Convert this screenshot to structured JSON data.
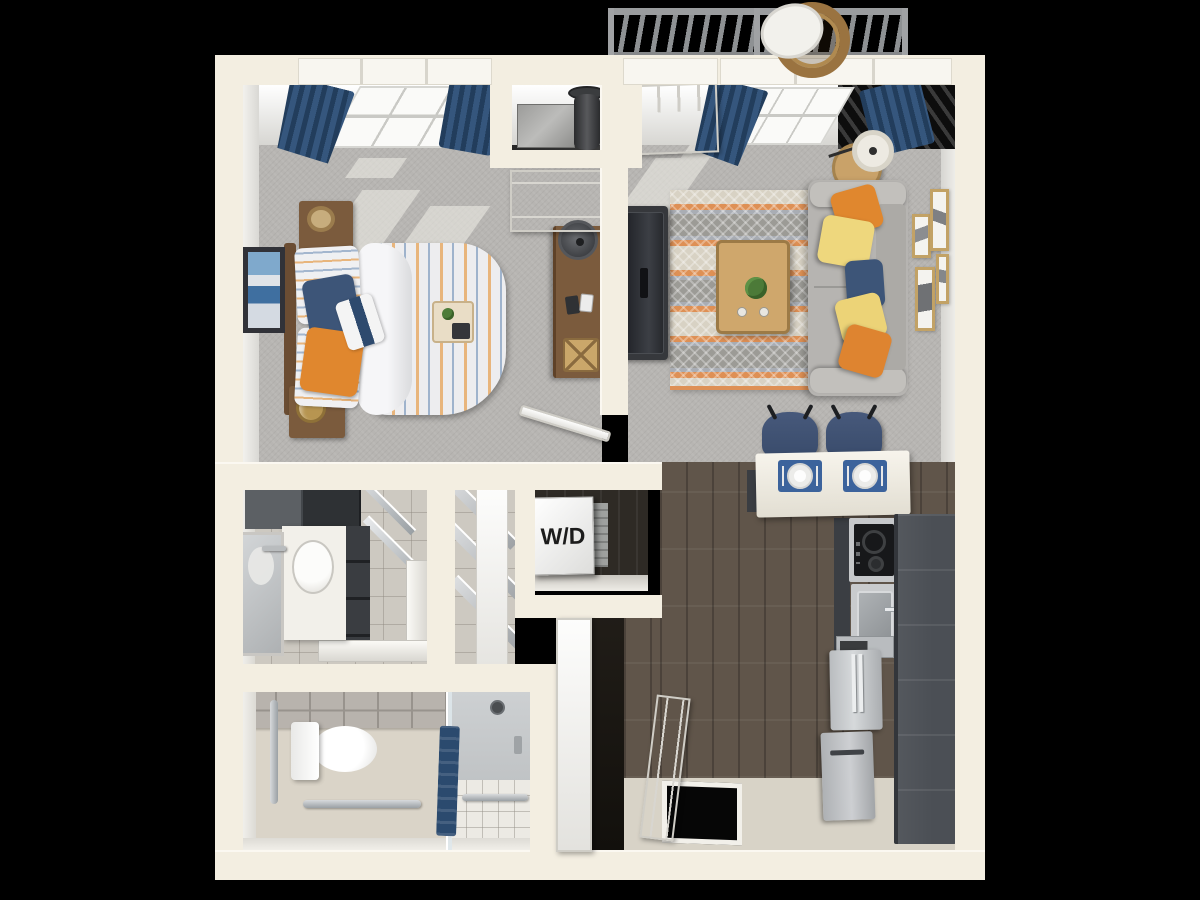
{
  "diagram": {
    "type": "3d-floor-plan",
    "unit": "one-bedroom apartment",
    "labels": {
      "washer_dryer": "W/D"
    },
    "rooms": [
      {
        "id": "bedroom",
        "name": "Bedroom",
        "floor": "carpet",
        "furniture": [
          "bed",
          "striped-duvet",
          "pillows",
          "nightstand-top",
          "nightstand-bottom",
          "table-lamp",
          "hat",
          "breakfast-tray",
          "desk",
          "desk-lamp",
          "basket",
          "wall-art",
          "window",
          "navy-curtains"
        ]
      },
      {
        "id": "living-room",
        "name": "Living Room",
        "floor": "carpet",
        "furniture": [
          "sofa",
          "throw-pillows",
          "area-rug",
          "coffee-table",
          "plant",
          "tv",
          "tv-stand",
          "floor-lamp",
          "side-table",
          "gallery-frames",
          "balcony-door",
          "window",
          "navy-curtains"
        ]
      },
      {
        "id": "balcony",
        "name": "Balcony",
        "floor": "deck",
        "furniture": [
          "railing",
          "hanging-wicker-chair"
        ]
      },
      {
        "id": "kitchen",
        "name": "Kitchen",
        "floor": "wood",
        "furniture": [
          "breakfast-bar",
          "bar-stools",
          "place-settings",
          "cooktop",
          "sink",
          "tall-cabinets",
          "microwave",
          "refrigerator",
          "dishwasher"
        ]
      },
      {
        "id": "entry",
        "name": "Entry",
        "floor": "wood",
        "furniture": [
          "front-door"
        ]
      },
      {
        "id": "laundry-closet",
        "name": "Laundry Closet",
        "floor": "wood",
        "furniture": [
          "stacked-washer-dryer"
        ]
      },
      {
        "id": "closet",
        "name": "Closet",
        "floor": "tile",
        "furniture": [
          "wire-shelving",
          "door"
        ]
      },
      {
        "id": "vanity-bathroom",
        "name": "Bathroom Vanity",
        "floor": "tile",
        "furniture": [
          "vanity-counter",
          "sink",
          "faucet",
          "mirror",
          "upper-cabinets",
          "drawer-stack",
          "shower-curb",
          "glass-door"
        ]
      },
      {
        "id": "bathroom",
        "name": "Accessible Bathroom",
        "floor": "tile",
        "furniture": [
          "toilet",
          "grab-bars",
          "roll-in-shower",
          "shower-head",
          "towel",
          "glass-partition"
        ]
      },
      {
        "id": "mechanical-closet",
        "name": "Mechanical Closet",
        "floor": "concrete",
        "furniture": [
          "water-heater",
          "hvac-box"
        ]
      }
    ],
    "palette": {
      "background": "#000000",
      "wall": "#f3eee1",
      "wall_face": "#ffffff",
      "carpet": "#b7b5b2",
      "wood_floor": "#60554a",
      "dark_wood": "#2c2824",
      "entry_floor": "#d8d3c7",
      "tile_floor": "#cdc9c1",
      "bath_floor": "#dad4c8",
      "accent_navy": "#2e4a6e",
      "accent_orange": "#e0872e",
      "accent_yellow": "#eed77d",
      "cabinet_dark": "#4b4f55",
      "stainless": "#c4c7c9",
      "counter_white": "#f5f2ea",
      "frame_gold": "#c2a266",
      "furniture_wood": "#7b5b3d",
      "table_wood": "#cfa76c"
    }
  }
}
